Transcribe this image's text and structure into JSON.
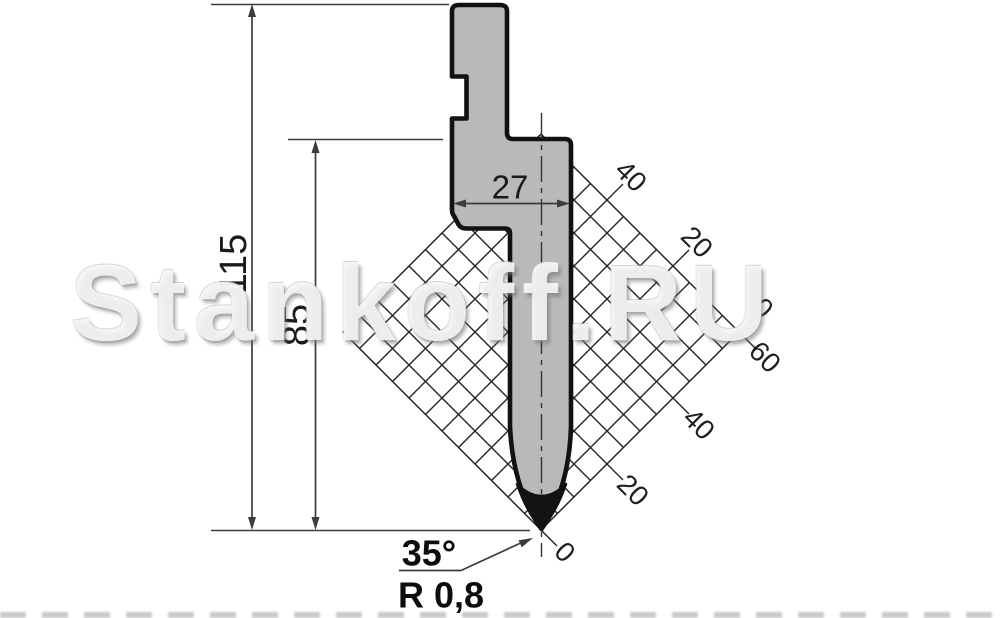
{
  "watermark": {
    "text": "Stankoff.RU"
  },
  "dimensions": {
    "total_height": {
      "value": "115"
    },
    "shoulder_height": {
      "value": "85"
    },
    "body_width": {
      "value": "27"
    },
    "tip_angle": {
      "value": "35°"
    },
    "tip_radius": {
      "value": "R 0,8"
    }
  },
  "grid": {
    "upper_labels": [
      "40",
      "20",
      "0"
    ],
    "lower_labels": [
      "60",
      "40",
      "20",
      "0"
    ]
  },
  "colors": {
    "punch_fill": "#b9b9b9",
    "outline": "#121212",
    "dim_line": "#3c3c3c",
    "grid_line": "#262626",
    "background": "#ffffff"
  }
}
